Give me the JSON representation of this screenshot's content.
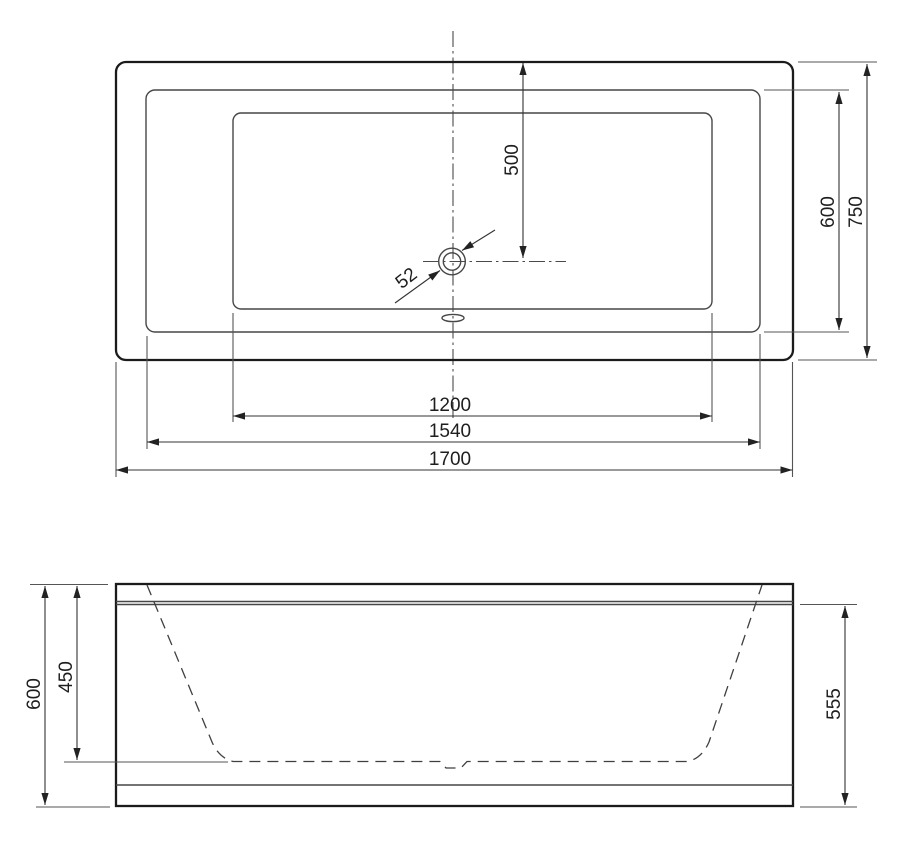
{
  "drawing": {
    "top_view": {
      "drain_offset": "500",
      "drain_diameter": "52",
      "inner_width": "600",
      "overall_width": "750",
      "basin_length": "1200",
      "inner_length": "1540",
      "overall_length": "1700"
    },
    "front_view": {
      "overall_height": "600",
      "interior_depth": "450",
      "apron_height": "555"
    },
    "colors": {
      "background": "#ffffff",
      "main_line": "#1b1b1b",
      "thin_line": "#474747",
      "dimension_line": "#333333"
    }
  }
}
